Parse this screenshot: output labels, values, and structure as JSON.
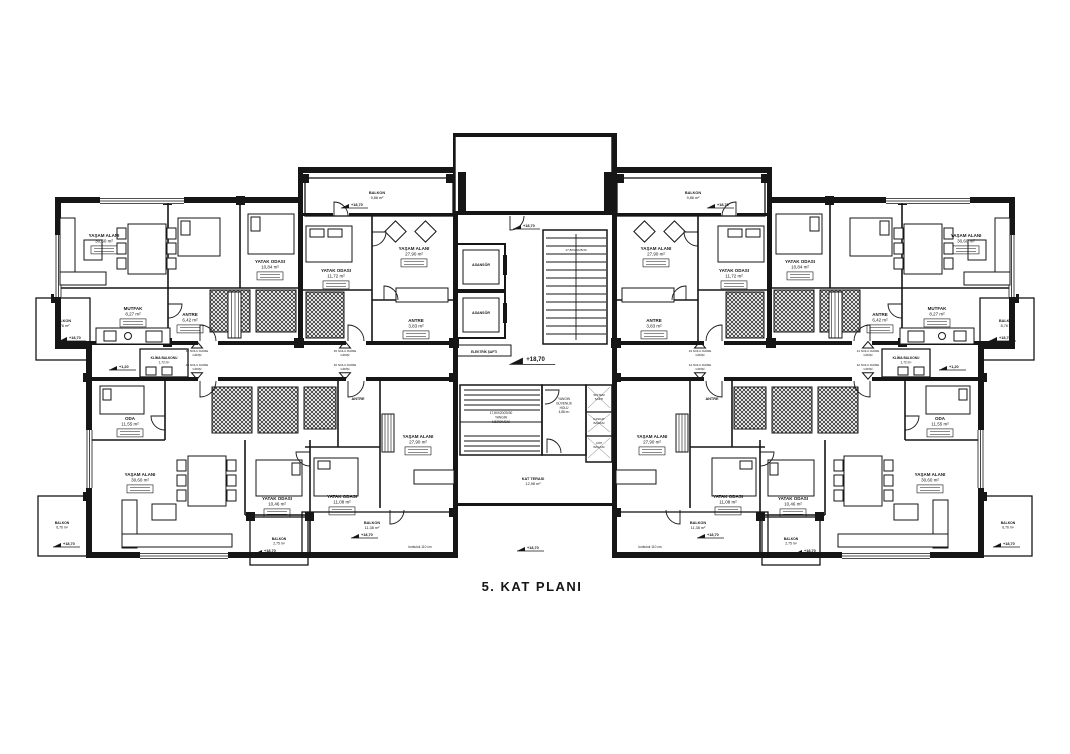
{
  "title": "5. KAT PLANI",
  "colors": {
    "ink": "#161616",
    "paper": "#ffffff"
  },
  "plan": {
    "labels": [
      {
        "lines": [
          "YAŞAM ALANI",
          "30,60 m²"
        ],
        "x": 104,
        "y": 237,
        "box": true
      },
      {
        "lines": [
          "YATAK ODASI",
          "10,84 m²"
        ],
        "x": 270,
        "y": 263,
        "box": true
      },
      {
        "lines": [
          "MUTFAK",
          "8,27 m²"
        ],
        "x": 133,
        "y": 310,
        "box": true
      },
      {
        "lines": [
          "ANTRE",
          "6,42 m²"
        ],
        "x": 190,
        "y": 316,
        "box": true
      },
      {
        "lines": [
          "BALKON",
          "8,76 m²"
        ],
        "x": 63,
        "y": 322,
        "fs": 3.8
      },
      {
        "lines": [
          "BALKON",
          "9,86 m²"
        ],
        "x": 377,
        "y": 194,
        "fs": 3.8
      },
      {
        "lines": [
          "YATAK ODASI",
          "11,72 m²"
        ],
        "x": 336,
        "y": 272,
        "box": true
      },
      {
        "lines": [
          "YAŞAM ALANI",
          "27,90 m²"
        ],
        "x": 414,
        "y": 250,
        "box": true
      },
      {
        "lines": [
          "ANTRE",
          "3,83 m²"
        ],
        "x": 416,
        "y": 322,
        "box": true
      },
      {
        "lines": [
          "ASANSÖR"
        ],
        "x": 481,
        "y": 266,
        "fs": 3.6
      },
      {
        "lines": [
          "ASANSÖR"
        ],
        "x": 481,
        "y": 314,
        "fs": 3.6
      },
      {
        "lines": [
          "17,80X20/25/30"
        ],
        "x": 576,
        "y": 251,
        "fs": 3,
        "plain": true
      },
      {
        "lines": [
          "ELEKTRİK ŞAFTI"
        ],
        "x": 484,
        "y": 353,
        "fs": 3.2
      },
      {
        "lines": [
          "17,80X20/25/30",
          "YANGIN",
          "MERDİVENİ"
        ],
        "x": 501,
        "y": 414,
        "fs": 3.2,
        "plain": true
      },
      {
        "lines": [
          "YANGIN",
          "GÜVENLİK",
          "HOLÜ",
          "4,88 m²"
        ],
        "x": 564,
        "y": 400,
        "fs": 3.2,
        "plain": true
      },
      {
        "lines": [
          "SİSTEM",
          "ŞAFTI"
        ],
        "x": 599,
        "y": 396,
        "fs": 3,
        "plain": true
      },
      {
        "lines": [
          "KASKAT",
          "BACASI"
        ],
        "x": 599,
        "y": 420,
        "fs": 3,
        "plain": true
      },
      {
        "lines": [
          "ÇÖP",
          "BACASI"
        ],
        "x": 599,
        "y": 444,
        "fs": 3,
        "plain": true
      },
      {
        "lines": [
          "KAT TERASI",
          "12,98 m²"
        ],
        "x": 533,
        "y": 480,
        "fs": 3.8
      },
      {
        "lines": [
          "ANTRE"
        ],
        "x": 358,
        "y": 400,
        "fs": 3.8
      },
      {
        "lines": [
          "YAŞAM ALANI",
          "27,90 m²"
        ],
        "x": 418,
        "y": 438,
        "box": true
      },
      {
        "lines": [
          "YATAK ODASI",
          "11,08 m²"
        ],
        "x": 342,
        "y": 498,
        "box": true
      },
      {
        "lines": [
          "BALKON",
          "11,38 m²"
        ],
        "x": 372,
        "y": 524,
        "fs": 3.8
      },
      {
        "lines": [
          "korkuluk 110 cm"
        ],
        "x": 420,
        "y": 548,
        "fs": 3.2,
        "plain": true
      },
      {
        "lines": [
          "ODA",
          "11,55 m²"
        ],
        "x": 130,
        "y": 420,
        "box": true
      },
      {
        "lines": [
          "KLİMA BALKONU",
          "1,72 m²"
        ],
        "x": 164,
        "y": 359,
        "fs": 3.2
      },
      {
        "lines": [
          "YAŞAM ALANI",
          "30,60 m²"
        ],
        "x": 140,
        "y": 476,
        "box": true
      },
      {
        "lines": [
          "YATAK ODASI",
          "10,46 m²"
        ],
        "x": 277,
        "y": 500,
        "box": true
      },
      {
        "lines": [
          "BALKON",
          "2,75 m²"
        ],
        "x": 279,
        "y": 540,
        "fs": 3.4
      },
      {
        "lines": [
          "BALKON",
          "6,76 m²"
        ],
        "x": 62,
        "y": 524,
        "fs": 3.4
      },
      {
        "lines": [
          "47 NOLU DAİRE",
          "GİRİŞİ"
        ],
        "x": 197,
        "y": 352,
        "fs": 3,
        "plain": true,
        "tri": "up",
        "name": "entrance-label-47"
      },
      {
        "lines": [
          "48 NOLU DAİRE",
          "GİRİŞİ"
        ],
        "x": 197,
        "y": 366,
        "fs": 3,
        "plain": true,
        "tri": "down",
        "name": "entrance-label-48"
      },
      {
        "lines": [
          "45 NOLU DAİRE",
          "GİRİŞİ"
        ],
        "x": 345,
        "y": 352,
        "fs": 3,
        "plain": true,
        "tri": "up",
        "name": "entrance-label-45"
      },
      {
        "lines": [
          "46 NOLU DAİRE",
          "GİRİŞİ"
        ],
        "x": 345,
        "y": 366,
        "fs": 3,
        "plain": true,
        "tri": "down",
        "name": "entrance-label-46"
      },
      {
        "lines": [
          "43 NOLU DAİRE",
          "GİRİŞİ"
        ],
        "x": 700,
        "y": 352,
        "fs": 3,
        "plain": true,
        "tri": "up",
        "name": "entrance-label-43"
      },
      {
        "lines": [
          "44 NOLU DAİRE",
          "GİRİŞİ"
        ],
        "x": 700,
        "y": 366,
        "fs": 3,
        "plain": true,
        "tri": "down",
        "name": "entrance-label-44"
      },
      {
        "lines": [
          "41 NOLU DAİRE",
          "GİRİŞİ"
        ],
        "x": 868,
        "y": 352,
        "fs": 3,
        "plain": true,
        "tri": "up",
        "name": "entrance-label-41"
      },
      {
        "lines": [
          "42 NOLU DAİRE",
          "GİRİŞİ"
        ],
        "x": 868,
        "y": 366,
        "fs": 3,
        "plain": true,
        "tri": "down",
        "name": "entrance-label-42"
      },
      {
        "lines": [
          "YAŞAM ALANI",
          "30,60 m²"
        ],
        "x": 966,
        "y": 237,
        "box": true
      },
      {
        "lines": [
          "YATAK ODASI",
          "10,84 m²"
        ],
        "x": 800,
        "y": 263,
        "box": true
      },
      {
        "lines": [
          "MUTFAK",
          "8,27 m²"
        ],
        "x": 937,
        "y": 310,
        "box": true
      },
      {
        "lines": [
          "ANTRE",
          "6,42 m²"
        ],
        "x": 880,
        "y": 316,
        "box": true
      },
      {
        "lines": [
          "BALKON",
          "8,76 m²"
        ],
        "x": 1007,
        "y": 322,
        "fs": 3.8
      },
      {
        "lines": [
          "BALKON",
          "9,86 m²"
        ],
        "x": 693,
        "y": 194,
        "fs": 3.8
      },
      {
        "lines": [
          "YATAK ODASI",
          "11,72 m²"
        ],
        "x": 734,
        "y": 272,
        "box": true
      },
      {
        "lines": [
          "YAŞAM ALANI",
          "27,90 m²"
        ],
        "x": 656,
        "y": 250,
        "box": true
      },
      {
        "lines": [
          "ANTRE",
          "3,83 m²"
        ],
        "x": 654,
        "y": 322,
        "box": true
      },
      {
        "lines": [
          "ANTRE"
        ],
        "x": 712,
        "y": 400,
        "fs": 3.8
      },
      {
        "lines": [
          "YAŞAM ALANI",
          "27,90 m²"
        ],
        "x": 652,
        "y": 438,
        "box": true
      },
      {
        "lines": [
          "YATAK ODASI",
          "11,08 m²"
        ],
        "x": 728,
        "y": 498,
        "box": true
      },
      {
        "lines": [
          "BALKON",
          "11,38 m²"
        ],
        "x": 698,
        "y": 524,
        "fs": 3.8
      },
      {
        "lines": [
          "korkuluk 110 cm"
        ],
        "x": 650,
        "y": 548,
        "fs": 3.2,
        "plain": true
      },
      {
        "lines": [
          "ODA",
          "11,55 m²"
        ],
        "x": 940,
        "y": 420,
        "box": true
      },
      {
        "lines": [
          "KLİMA BALKONU",
          "1,72 m²"
        ],
        "x": 906,
        "y": 359,
        "fs": 3.2
      },
      {
        "lines": [
          "YAŞAM ALANI",
          "30,60 m²"
        ],
        "x": 930,
        "y": 476,
        "box": true
      },
      {
        "lines": [
          "YATAK ODASI",
          "10,46 m²"
        ],
        "x": 793,
        "y": 500,
        "box": true
      },
      {
        "lines": [
          "BALKON",
          "2,75 m²"
        ],
        "x": 791,
        "y": 540,
        "fs": 3.4
      },
      {
        "lines": [
          "BALKON",
          "6,76 m²"
        ],
        "x": 1008,
        "y": 524,
        "fs": 3.4
      }
    ],
    "markers": [
      {
        "label": "+18,70",
        "x": 70,
        "y": 339
      },
      {
        "label": "+18,70",
        "x": 352,
        "y": 206
      },
      {
        "label": "+18,70",
        "x": 524,
        "y": 227
      },
      {
        "label": "+18,70",
        "x": 528,
        "y": 361,
        "big": true
      },
      {
        "label": "+18,70",
        "x": 718,
        "y": 206
      },
      {
        "label": "+18,70",
        "x": 1000,
        "y": 339
      },
      {
        "label": "+1,20",
        "x": 120,
        "y": 368
      },
      {
        "label": "+1,20",
        "x": 950,
        "y": 368
      },
      {
        "label": "+18,70",
        "x": 362,
        "y": 536
      },
      {
        "label": "+18,70",
        "x": 708,
        "y": 536
      },
      {
        "label": "+18,70",
        "x": 265,
        "y": 552
      },
      {
        "label": "+18,70",
        "x": 805,
        "y": 552
      },
      {
        "label": "+18,70",
        "x": 64,
        "y": 545
      },
      {
        "label": "+18,70",
        "x": 1004,
        "y": 545
      },
      {
        "label": "+18,70",
        "x": 528,
        "y": 549
      }
    ]
  }
}
